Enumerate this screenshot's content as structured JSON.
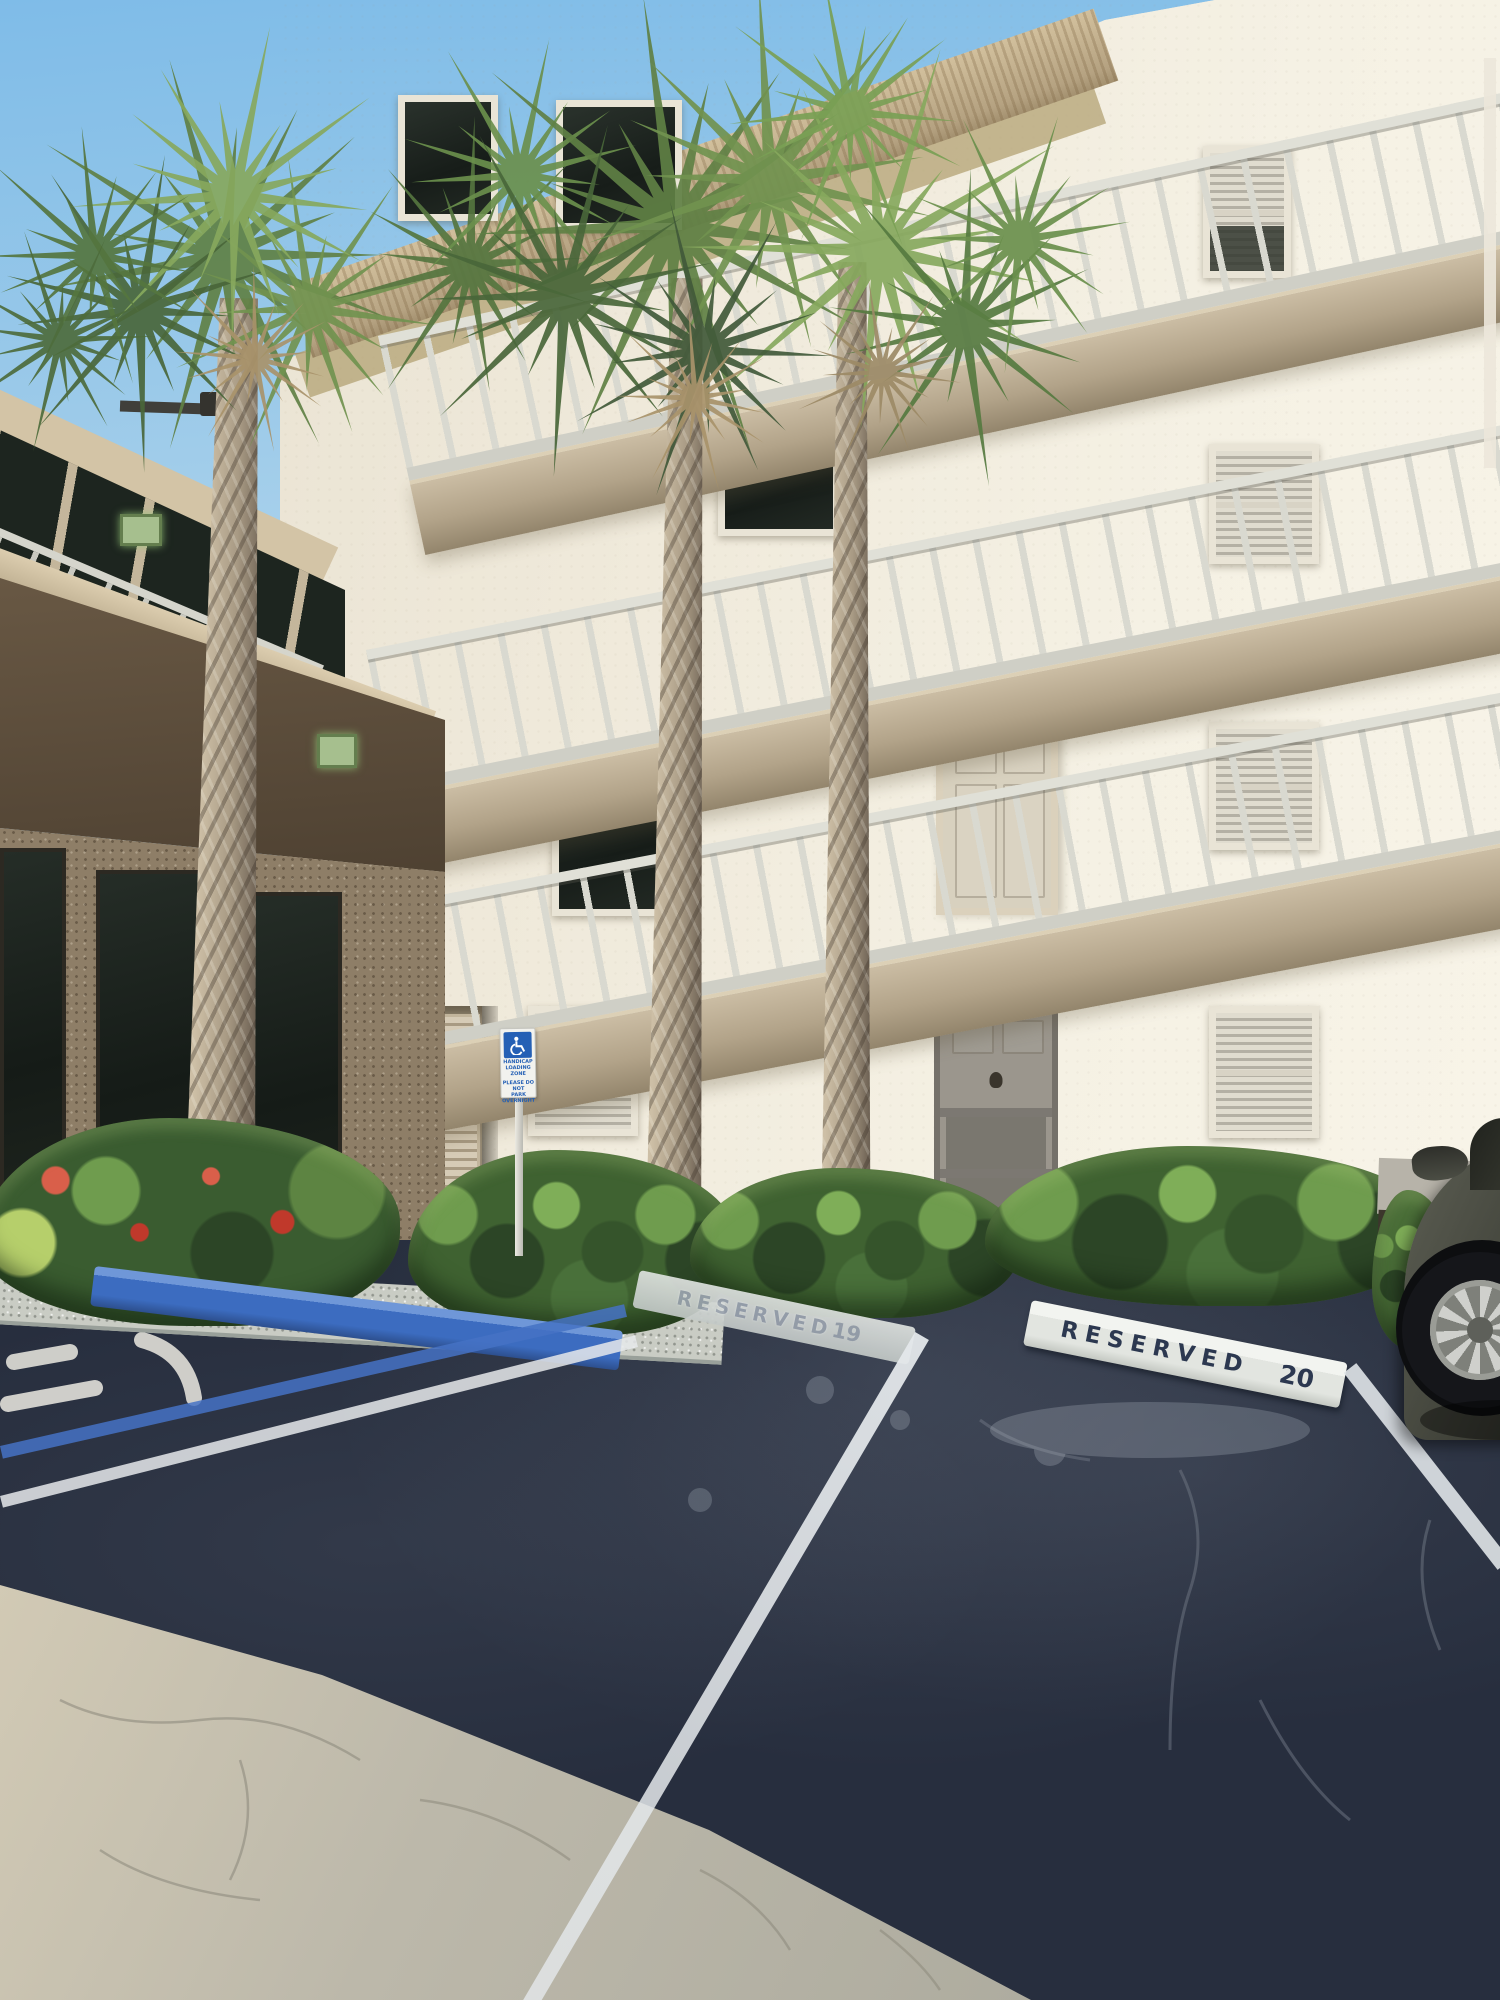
{
  "units": {
    "upper_door_label": "207",
    "lower_door_label": "107"
  },
  "parking": {
    "curb_19": {
      "label": "RESERVED",
      "number": "19"
    },
    "curb_20": {
      "label": "RESERVED",
      "number": "20"
    }
  },
  "handicap_sign": {
    "icon": "wheelchair",
    "line1": "HANDICAP",
    "line2": "LOADING ZONE",
    "line3": "PLEASE DO NOT",
    "line4": "PARK OVERNIGHT"
  },
  "colors": {
    "sky_blue": "#9ccae9",
    "facade_cream": "#efe9da",
    "roof_tan": "#b5a281",
    "railing_gray": "#d9d9d0",
    "hedge_green": "#3f6231",
    "palm_green": "#6f9150",
    "asphalt_dark": "#272e3e",
    "asphalt_sunlit": "#b6b3a6",
    "curb_blue": "#3c6cc0",
    "curb_white": "#e9ebe7",
    "stencil_navy": "#2c3850"
  }
}
